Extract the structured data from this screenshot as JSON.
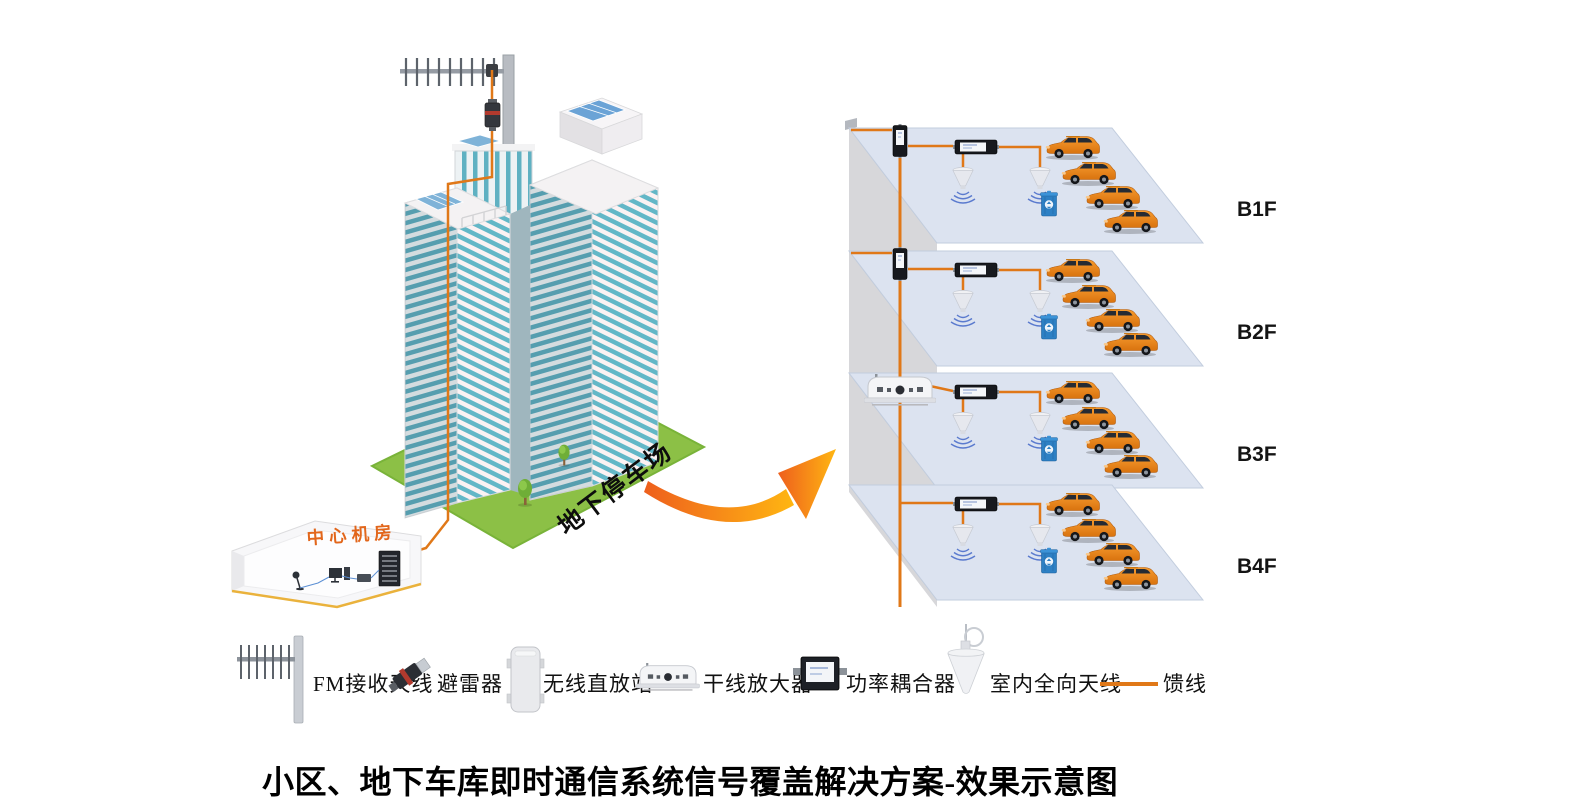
{
  "title": "小区、地下车库即时通信系统信号覆盖解决方案-效果示意图",
  "scene": {
    "machine_room_label": "中心机房",
    "parking_arrow_label": "地下停车场"
  },
  "floors": [
    {
      "label": "B1F",
      "wall_device": "vertical-coupler",
      "cable_entry": true
    },
    {
      "label": "B2F",
      "wall_device": "vertical-coupler",
      "cable_entry": true
    },
    {
      "label": "B3F",
      "wall_device": "trunk-amplifier",
      "cable_entry": false
    },
    {
      "label": "B4F",
      "wall_device": "none",
      "cable_entry": false
    }
  ],
  "legend": {
    "items": [
      {
        "label": "FM接收天线",
        "icon": "yagi-antenna-icon"
      },
      {
        "label": "避雷器",
        "icon": "lightning-arrester-icon"
      },
      {
        "label": "无线直放站",
        "icon": "wireless-repeater-icon"
      },
      {
        "label": "干线放大器",
        "icon": "trunk-amplifier-icon"
      },
      {
        "label": "功率耦合器",
        "icon": "power-coupler-icon"
      },
      {
        "label": "室内全向天线",
        "icon": "indoor-omni-antenna-icon"
      },
      {
        "label": "馈线",
        "icon": "feeder-line-icon"
      }
    ]
  },
  "colors": {
    "feeder": "#E07818",
    "arrow": "#F7941E",
    "car": "#E8821E",
    "grass": "#8CC046",
    "floor_slab": "#DCE3F0",
    "trash_bin": "#2D80C4",
    "machine_room_label": "#E2661B",
    "window_teal": "#5FB1C2"
  }
}
